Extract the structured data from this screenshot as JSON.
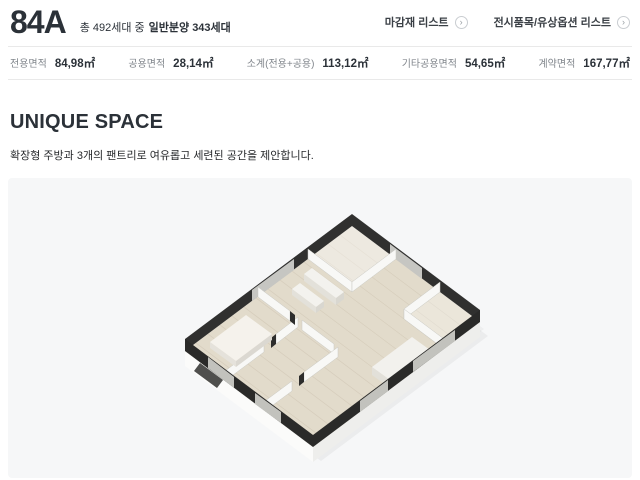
{
  "header": {
    "title": "84A",
    "units_prefix": "총 492세대 중",
    "units_bold": "일반분양 343세대",
    "links": [
      {
        "label": "마감재 리스트"
      },
      {
        "label": "전시품목/유상옵션 리스트"
      }
    ]
  },
  "icons": {
    "chevron_right": "›"
  },
  "stats": {
    "items": [
      {
        "label": "전용면적",
        "value": "84,98㎡"
      },
      {
        "label": "공용면적",
        "value": "28,14㎡"
      },
      {
        "label": "소계(전용+공용)",
        "value": "113,12㎡"
      },
      {
        "label": "기타공용면적",
        "value": "54,65㎡"
      },
      {
        "label": "계약면적",
        "value": "167,77㎡"
      }
    ]
  },
  "section": {
    "title": "UNIQUE SPACE",
    "description": "확장형 주방과 3개의 팬트리로 여유롭고 세련된 공간을 제안합니다."
  },
  "floorplan": {
    "label": "84A 3D floor plan render",
    "colors": {
      "panel_bg": "#f6f7f8",
      "outer_wall": "#2a2a29",
      "interior_wall": "#f8f8f6",
      "floor_wood": "#e2dbcb",
      "window": "#c2c2bd",
      "text_dark": "#2b3138",
      "text_gray": "#82878d",
      "divider": "#e9e9e9"
    }
  }
}
